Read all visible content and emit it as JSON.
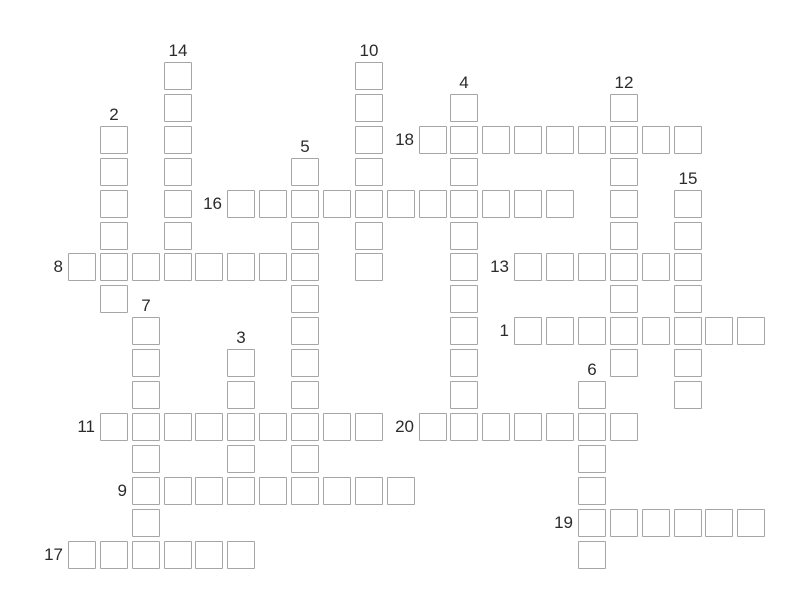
{
  "colors": {
    "background": "#ffffff",
    "cell_border": "#a6a6a6",
    "cell_fill": "#ffffff",
    "clue_number": "#2b2b2b"
  },
  "crossword": {
    "grid_cols": 22,
    "grid_rows": 16,
    "clue_numbers": [
      1,
      2,
      3,
      4,
      5,
      6,
      7,
      8,
      9,
      10,
      11,
      12,
      13,
      14,
      15,
      16,
      17,
      18,
      19,
      20
    ],
    "entries": [
      {
        "number": 1,
        "direction": "across",
        "col": 14,
        "row": 8,
        "length": 8
      },
      {
        "number": 2,
        "direction": "down",
        "col": 1,
        "row": 2,
        "length": 6
      },
      {
        "number": 3,
        "direction": "down",
        "col": 5,
        "row": 9,
        "length": 5
      },
      {
        "number": 4,
        "direction": "down",
        "col": 12,
        "row": 1,
        "length": 11
      },
      {
        "number": 5,
        "direction": "down",
        "col": 7,
        "row": 3,
        "length": 11
      },
      {
        "number": 6,
        "direction": "down",
        "col": 16,
        "row": 10,
        "length": 6
      },
      {
        "number": 7,
        "direction": "down",
        "col": 2,
        "row": 8,
        "length": 8
      },
      {
        "number": 8,
        "direction": "across",
        "col": 0,
        "row": 6,
        "length": 8
      },
      {
        "number": 9,
        "direction": "across",
        "col": 2,
        "row": 13,
        "length": 9
      },
      {
        "number": 10,
        "direction": "down",
        "col": 9,
        "row": 0,
        "length": 7
      },
      {
        "number": 11,
        "direction": "across",
        "col": 1,
        "row": 11,
        "length": 9
      },
      {
        "number": 12,
        "direction": "down",
        "col": 17,
        "row": 1,
        "length": 9
      },
      {
        "number": 13,
        "direction": "across",
        "col": 14,
        "row": 6,
        "length": 6
      },
      {
        "number": 14,
        "direction": "down",
        "col": 3,
        "row": 0,
        "length": 7
      },
      {
        "number": 15,
        "direction": "down",
        "col": 19,
        "row": 4,
        "length": 7
      },
      {
        "number": 16,
        "direction": "across",
        "col": 5,
        "row": 4,
        "length": 11
      },
      {
        "number": 17,
        "direction": "across",
        "col": 0,
        "row": 15,
        "length": 6
      },
      {
        "number": 18,
        "direction": "across",
        "col": 11,
        "row": 2,
        "length": 9
      },
      {
        "number": 19,
        "direction": "across",
        "col": 16,
        "row": 14,
        "length": 6
      },
      {
        "number": 20,
        "direction": "across",
        "col": 11,
        "row": 11,
        "length": 7
      }
    ],
    "cell_values": []
  }
}
